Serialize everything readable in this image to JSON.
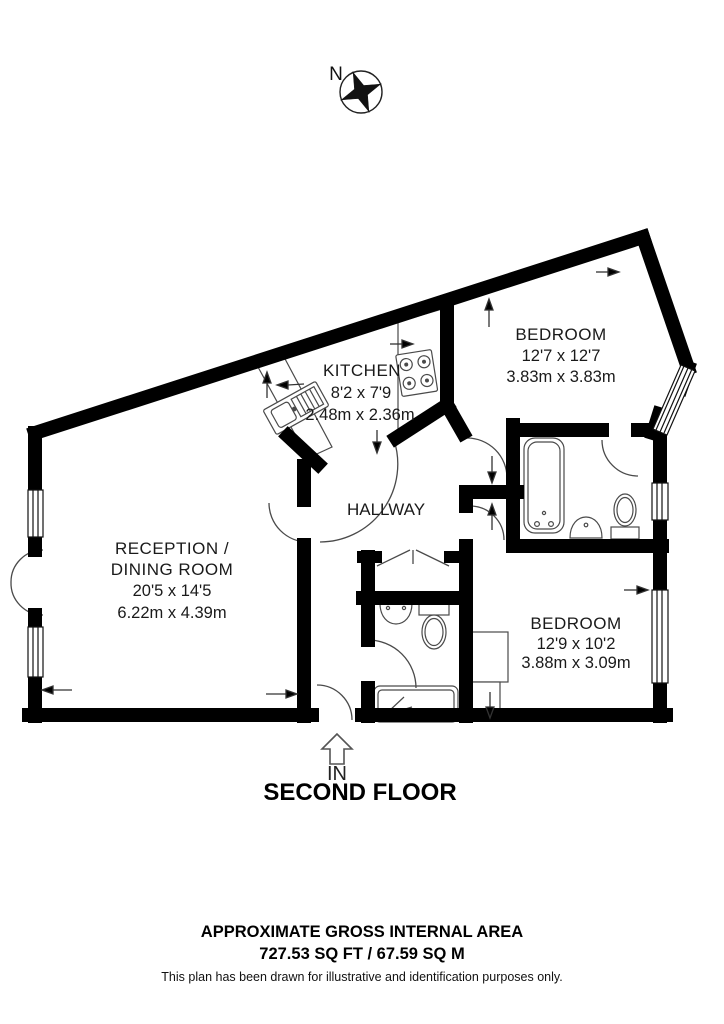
{
  "compass": {
    "north_label": "N"
  },
  "rooms": {
    "kitchen": {
      "name": "KITCHEN",
      "dims_ft": "8'2 x 7'9",
      "dims_m": "2.48m x 2.36m"
    },
    "bedroom1": {
      "name": "BEDROOM",
      "dims_ft": "12'7 x 12'7",
      "dims_m": "3.83m x 3.83m"
    },
    "reception": {
      "name_line1": "RECEPTION /",
      "name_line2": "DINING ROOM",
      "dims_ft": "20'5 x 14'5",
      "dims_m": "6.22m x 4.39m"
    },
    "hallway": {
      "name": "HALLWAY"
    },
    "bedroom2": {
      "name": "BEDROOM",
      "dims_ft": "12'9 x 10'2",
      "dims_m": "3.88m x 3.09m"
    }
  },
  "entrance": {
    "label": "IN"
  },
  "floor": {
    "title": "SECOND FLOOR"
  },
  "footer": {
    "area_heading": "APPROXIMATE GROSS INTERNAL AREA",
    "area_value": "727.53 SQ FT / 67.59 SQ M",
    "disclaimer": "This plan has been drawn for illustrative and identification purposes only."
  },
  "colors": {
    "wall": "#000000",
    "background": "#ffffff",
    "thin_line": "#4a4a4a"
  }
}
